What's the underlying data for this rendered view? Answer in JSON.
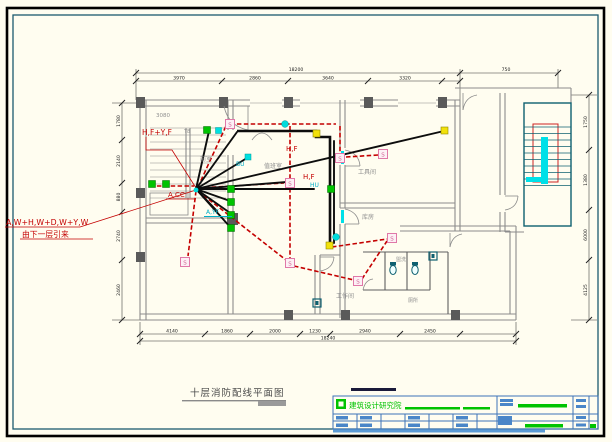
{
  "page": {
    "background": "#FFFDF0",
    "frame_outer_color": "#000000",
    "frame_inner_color": "#1B5A6E"
  },
  "plan": {
    "feeder": {
      "line1": "A,W+H,W+D,W+Y,W",
      "line2": "由下一层引来"
    },
    "wire_labels": {
      "riser": "H,F+Y,F",
      "acc": "A,CC",
      "hf1": "H,F",
      "hf2": "H,F",
      "bu": "BU",
      "hu": "HU",
      "ayf": "A,YF"
    },
    "detector_glyph": "S",
    "rooms": {
      "num": "3080",
      "tag": "T8",
      "front": "前室",
      "duty": "值班室",
      "tool": "工具间",
      "store": "库房",
      "work": "工作间",
      "wash": "盥洗",
      "wc": "厕所"
    }
  },
  "dimensions": {
    "top_total": "18200",
    "top_right": "750",
    "top_segments": [
      "3970",
      "2860",
      "3640",
      "3320"
    ],
    "bottom_total": "18240",
    "bottom_segments": [
      "4140",
      "1860",
      "2000",
      "1230",
      "2940",
      "2450"
    ],
    "left_segments": [
      "1780",
      "2140",
      "880",
      "2740",
      "2460"
    ],
    "right_segments": [
      "1750",
      "1380",
      "6000",
      "4125"
    ]
  },
  "footer": {
    "drawing_title": "十层消防配线平面图"
  },
  "titleblock": {
    "company": "建筑设计研究院"
  }
}
